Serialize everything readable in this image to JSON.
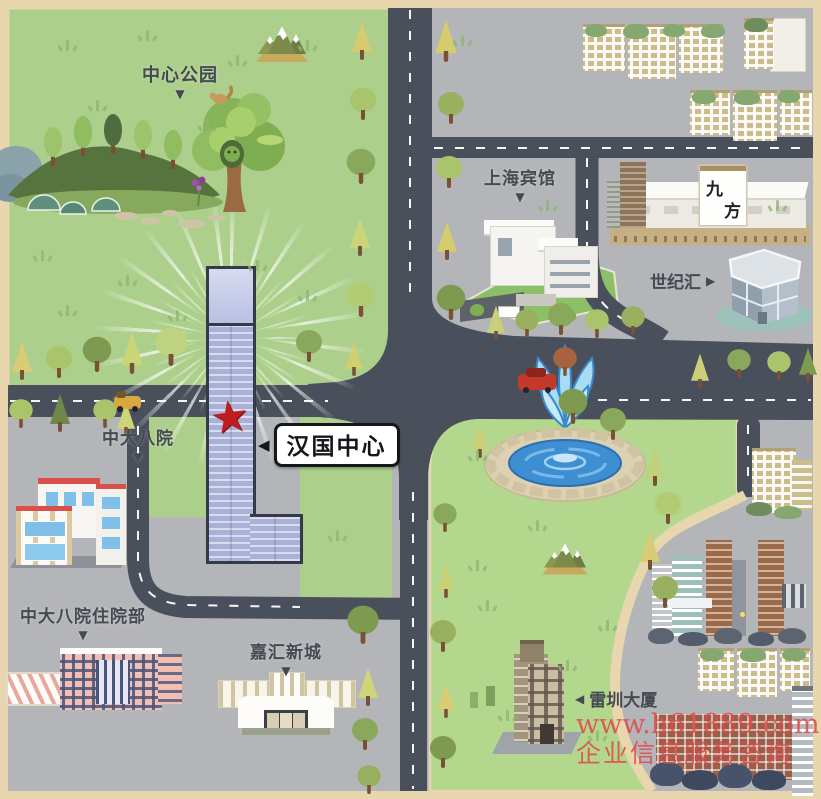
{
  "labels": {
    "central_park": {
      "text": "中心公园",
      "arrow": "▼"
    },
    "shanghai_hotel": {
      "text": "上海宾馆",
      "arrow": "▼"
    },
    "jiufang": {
      "char_top": "九",
      "char_bottom": "方"
    },
    "century_hui": {
      "text": "世纪汇",
      "arrow": "▶"
    },
    "hanguo_center": {
      "text": "汉国中心",
      "arrow": "◀"
    },
    "zhongda_hospital": {
      "text": "中大八院",
      "arrow": "▼"
    },
    "zhongda_inpatient": {
      "text": "中大八院住院部",
      "arrow": "▼"
    },
    "jiahui_town": {
      "text": "嘉汇新城",
      "arrow": "▼"
    },
    "leizhen_tower": {
      "text": "雷圳大厦",
      "arrow": "◀"
    }
  },
  "landmark_icons": {
    "star": "★"
  },
  "watermark": {
    "line1": "www.h61889.com",
    "line2": "企业信息服务咨询"
  },
  "colors": {
    "frame": "#e8d6ae",
    "park": "#adcf8c",
    "lawn": "#b4d78e",
    "gray": "#b4b5b8",
    "road": "#4a505b",
    "dash": "#ffffff",
    "tower": "#aab1d8",
    "tower-line": "#353b46",
    "star": "#c01c1e",
    "ink": "#454a52",
    "watermark": "#e24848",
    "water": "#3e8ed2",
    "stone": "#dcd1b2",
    "hotel-lawn": "#8cc068",
    "tuft": "#8cb673"
  },
  "map": {
    "trees": [
      [
        12,
        342,
        "c",
        "#d8cc74",
        1
      ],
      [
        46,
        346,
        "r",
        "#a9c46a",
        1
      ],
      [
        84,
        340,
        "r",
        "#7e9a50",
        1.1
      ],
      [
        122,
        336,
        "c",
        "#ccd478",
        1.1
      ],
      [
        158,
        334,
        "r",
        "#bed27f",
        1.2
      ],
      [
        296,
        330,
        "r",
        "#8aa85c",
        1
      ],
      [
        344,
        338,
        "c",
        "#d2cf72",
        0.9
      ],
      [
        8,
        396,
        "r",
        "#a9c46a",
        0.9
      ],
      [
        50,
        394,
        "c",
        "#6f8748",
        1
      ],
      [
        92,
        396,
        "r",
        "#a9c46a",
        0.9
      ],
      [
        116,
        398,
        "c",
        "#cdd57a",
        0.9
      ],
      [
        352,
        22,
        "c",
        "#d5cc6d",
        1
      ],
      [
        350,
        88,
        "r",
        "#a9c46a",
        1
      ],
      [
        348,
        152,
        "r",
        "#8aa85c",
        1.1
      ],
      [
        350,
        218,
        "c",
        "#ccd478",
        1
      ],
      [
        348,
        285,
        "r",
        "#b2cc74",
        1.1
      ],
      [
        436,
        24,
        "c",
        "#d5cc6d",
        1.1
      ],
      [
        438,
        92,
        "r",
        "#9ab061",
        1
      ],
      [
        436,
        156,
        "r",
        "#a9c46a",
        1
      ],
      [
        437,
        222,
        "c",
        "#d5cc6d",
        1
      ],
      [
        438,
        288,
        "r",
        "#7e9a50",
        1.1
      ],
      [
        486,
        302,
        "c",
        "#c9d077",
        0.9
      ],
      [
        514,
        306,
        "r",
        "#9ab061",
        0.9
      ],
      [
        548,
        303,
        "r",
        "#8aa85c",
        1
      ],
      [
        584,
        306,
        "r",
        "#a9c46a",
        0.9
      ],
      [
        620,
        303,
        "r",
        "#9ab061",
        0.9
      ],
      [
        552,
        344,
        "r",
        "#a5633f",
        0.9
      ],
      [
        690,
        350,
        "c",
        "#c9d077",
        0.9
      ],
      [
        726,
        346,
        "r",
        "#8aa85c",
        0.9
      ],
      [
        766,
        348,
        "r",
        "#a9c46a",
        0.9
      ],
      [
        798,
        344,
        "c",
        "#7e9a50",
        0.9
      ],
      [
        560,
        392,
        "r",
        "#7e9a50",
        1.1
      ],
      [
        600,
        408,
        "r",
        "#8aa85c",
        1
      ],
      [
        645,
        448,
        "c",
        "#c2d07b",
        1
      ],
      [
        655,
        492,
        "r",
        "#b2cc74",
        1
      ],
      [
        640,
        532,
        "c",
        "#d8cc74",
        1
      ],
      [
        652,
        576,
        "r",
        "#9ab061",
        1
      ],
      [
        470,
        420,
        "c",
        "#c9d077",
        0.9
      ],
      [
        350,
        612,
        "r",
        "#7e9a50",
        1.2
      ],
      [
        358,
        668,
        "c",
        "#cdd57a",
        1
      ],
      [
        352,
        718,
        "r",
        "#8aa85c",
        1
      ],
      [
        356,
        762,
        "r",
        "#9ab061",
        0.9
      ],
      [
        432,
        500,
        "r",
        "#8aa85c",
        0.9
      ],
      [
        436,
        560,
        "c",
        "#c9d077",
        0.9
      ],
      [
        430,
        620,
        "r",
        "#9ab061",
        1
      ],
      [
        436,
        680,
        "c",
        "#d8cc74",
        0.9
      ],
      [
        430,
        736,
        "r",
        "#7e9a50",
        1
      ]
    ],
    "grass": [
      [
        60,
        40
      ],
      [
        140,
        30
      ],
      [
        230,
        55
      ],
      [
        300,
        40
      ],
      [
        90,
        100
      ],
      [
        200,
        120
      ],
      [
        35,
        250
      ],
      [
        120,
        275
      ],
      [
        250,
        260
      ],
      [
        300,
        290
      ],
      [
        170,
        310
      ],
      [
        60,
        305
      ],
      [
        470,
        450
      ],
      [
        530,
        520
      ],
      [
        600,
        620
      ],
      [
        480,
        600
      ],
      [
        560,
        660
      ],
      [
        500,
        710
      ],
      [
        590,
        730
      ],
      [
        470,
        560
      ],
      [
        320,
        450
      ],
      [
        330,
        530
      ],
      [
        455,
        35
      ],
      [
        540,
        200
      ],
      [
        770,
        200
      ]
    ]
  }
}
